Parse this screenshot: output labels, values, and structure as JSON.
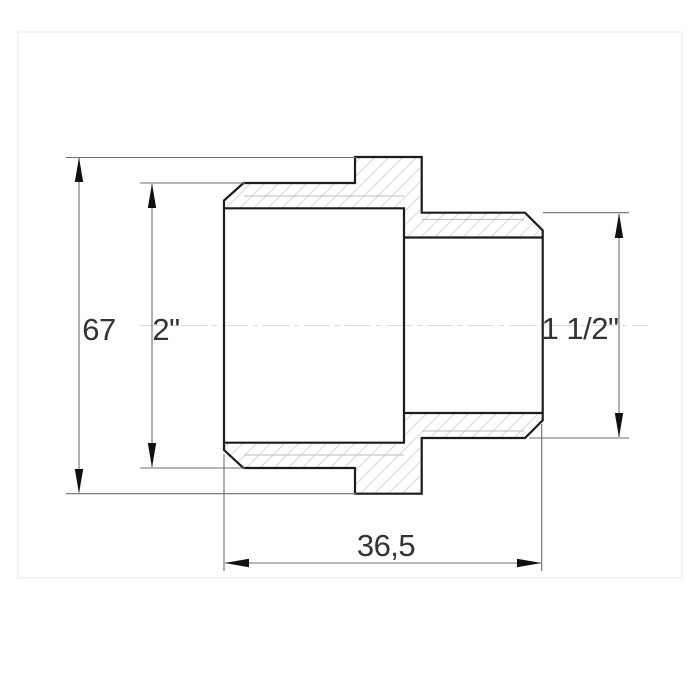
{
  "diagram": {
    "type": "technical-drawing",
    "subject": "threaded-reducing-adapter-cross-section",
    "dimensions": {
      "height": {
        "label": "67"
      },
      "female_thread": {
        "label": "2\""
      },
      "male_thread": {
        "label": "1 1/2\""
      },
      "length": {
        "label": "36,5"
      }
    },
    "colors": {
      "background": "#ffffff",
      "frame": "#e9e9e9",
      "outline": "#1c1c1c",
      "dimension_line": "#6f6f6f",
      "arrow": "#111111",
      "text": "#333333",
      "hatch": "#d8d8d8",
      "thread_line": "#bdbdbd",
      "centerline": "#dcdcdc"
    }
  }
}
